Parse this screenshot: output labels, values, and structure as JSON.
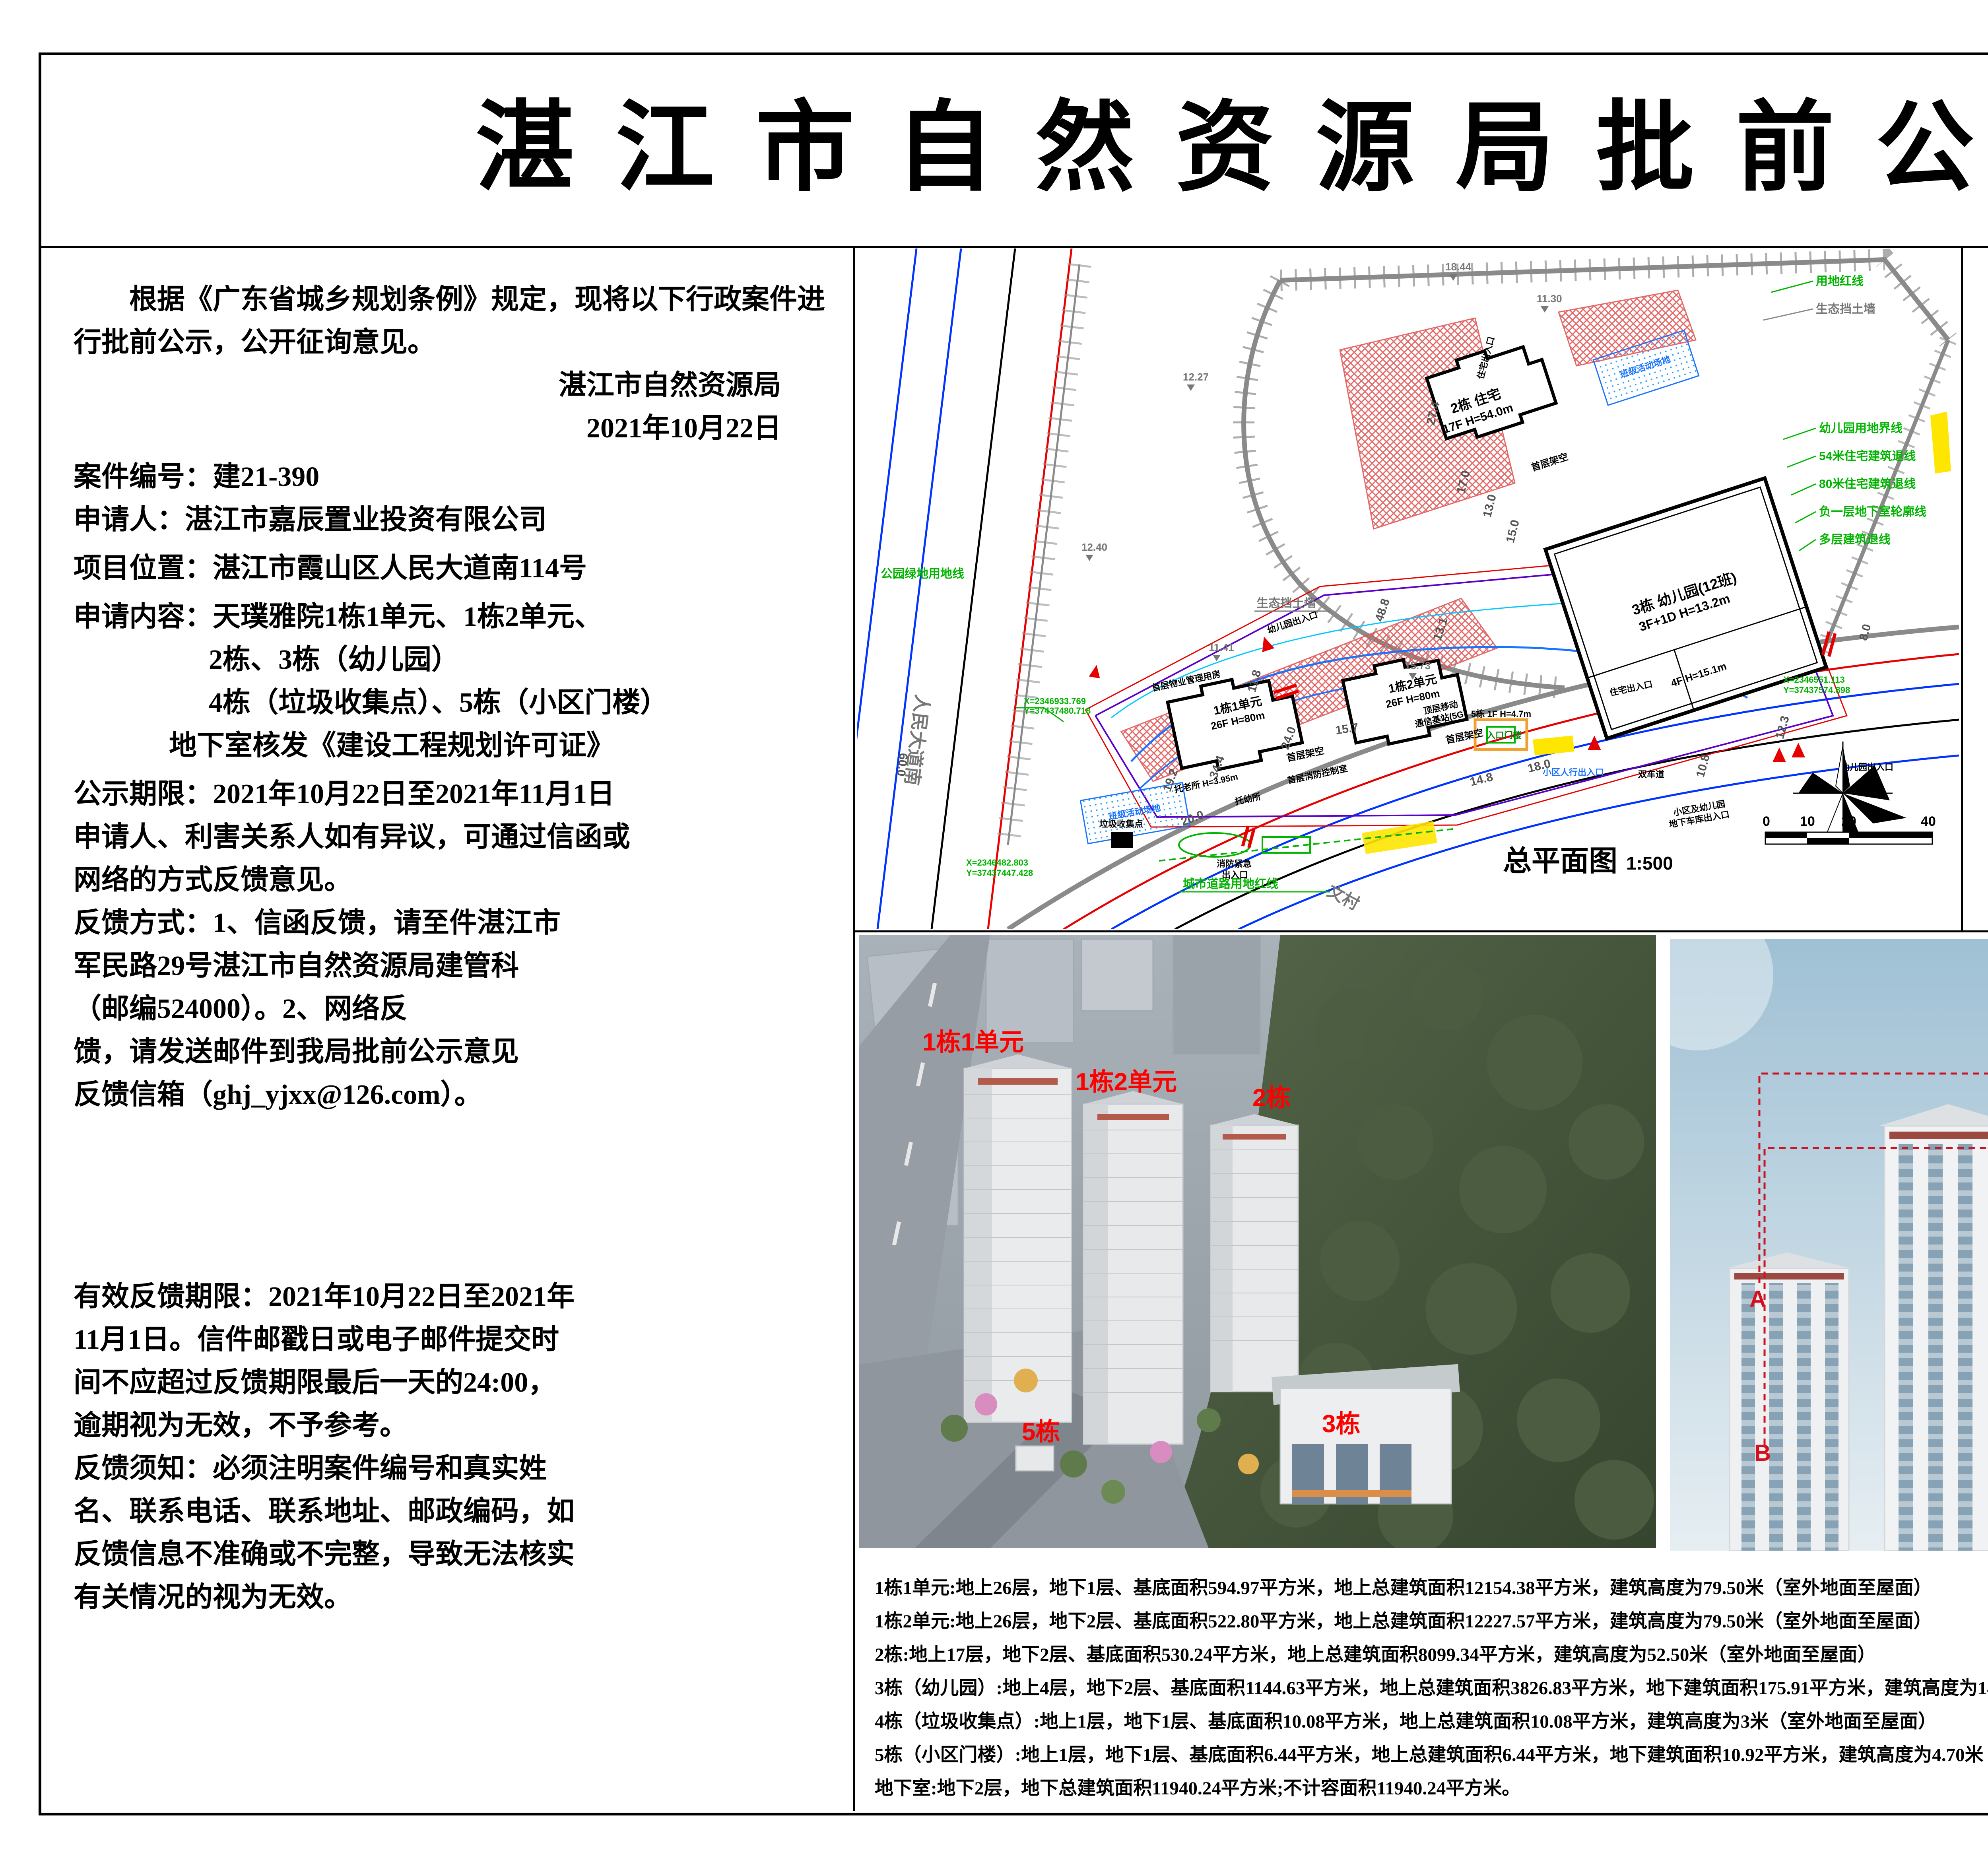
{
  "title": "湛江市自然资源局批前公示",
  "left": {
    "intro": "根据《广东省城乡规划条例》规定，现将以下行政案件进行批前公示，公开征询意见。",
    "agency": "湛江市自然资源局",
    "date": "2021年10月22日",
    "case_no": "案件编号：建21-390",
    "applicant": "申请人：湛江市嘉辰置业投资有限公司",
    "location": "项目位置：湛江市霞山区人民大道南114号",
    "content1": "申请内容：天璞雅院1栋1单元、1栋2单元、",
    "content2": "2栋、3栋（幼儿园）",
    "content3": "4栋（垃圾收集点）、5栋（小区门楼）",
    "content4": "地下室核发《建设工程规划许可证》",
    "period": "公示期限：2021年10月22日至2021年11月1日\n申请人、利害关系人如有异议，可通过信函或\n网络的方式反馈意见。",
    "method": "反馈方式：1、信函反馈，请至件湛江市\n军民路29号湛江市自然资源局建管科\n（邮编524000）。2、网络反\n馈，请发送邮件到我局批前公示意见\n反馈信箱（ghj_yjxx@126.com）。",
    "valid": "有效反馈期限：2021年10月22日至2021年\n11月1日。信件邮戳日或电子邮件提交时\n间不应超过反馈期限最后一天的24:00，\n逾期视为无效，不予参考。",
    "notice": "反馈须知：必须注明案件编号和真实姓\n名、联系电话、联系地址、邮政编码，如\n反馈信息不准确或不完整，导致无法核实\n有关情况的视为无效。"
  },
  "plan": {
    "name": "总平面图",
    "scale": "1:500",
    "ticks": [
      "0",
      "10",
      "20",
      "40"
    ],
    "labels": {
      "red_line": "用地红线",
      "eco_wall": "生态挡土墙",
      "kid_bound": "幼儿园用地界线",
      "setback54": "54米住宅建筑退线",
      "setback80": "80米住宅建筑退线",
      "basement": "负一层地下室轮廓线",
      "multi": "多层建筑退线",
      "b2a": "2栋 住宅",
      "b2b": "17F H=54.0m",
      "b3a": "3栋 幼儿园(12班)",
      "b3b": "3F+1D H=13.2m",
      "b3c": "4F H=15.1m",
      "b1u1a": "1栋1单元",
      "b1u1b": "26F H=80m",
      "b1u2a": "1栋2单元",
      "b1u2b": "26F H=80m",
      "stilt": "首层架空",
      "pm": "首层物业管理用房",
      "firectl": "首层消防控制室",
      "elder": "托老所 H=3.95m",
      "nursery": "托幼所",
      "sta1": "顶层移动",
      "sta2": "通信基站(5G)",
      "gate1": "5栋 1F H=4.7m",
      "gate2": "入口门楼",
      "ped": "小区人行出入口",
      "lane": "双车道",
      "garage1": "小区及幼儿园",
      "garage2": "地下车库出入口",
      "fire1": "消防紧急",
      "fire2": "出入口",
      "res_entry": "住宅出入口",
      "kid_entry": "幼儿园出入口",
      "play": "班级活动场地",
      "trash": "垃圾收集点",
      "road": "人民大道南",
      "wencun": "文村",
      "city_red": "城市道路用地红线",
      "park_green": "公园绿地用地线"
    },
    "dims": {
      "d1": "27.4",
      "d2": "17.0",
      "d3": "13.0",
      "d4": "15.0",
      "d5": "48.8",
      "d6": "13.1",
      "d7": "24.0",
      "d8": "34.4",
      "d9": "19.2",
      "d10": "11.8",
      "d11": "15.7",
      "d12": "20.0",
      "d13": "18.0",
      "d14": "14.8",
      "d15": "12.3",
      "d16": "10.8",
      "d17": "8.0",
      "d18": "60.0"
    },
    "elevs": {
      "m1": "12.27",
      "m2": "11.41",
      "m3": "12.40",
      "m4": "18.44",
      "m5": "11.30",
      "m6": "15.73"
    },
    "coords": {
      "c1a": "X=2346551.113",
      "c1b": "Y=37437574.898",
      "c2a": "X=2346482.803",
      "c2b": "Y=37437447.428",
      "c3a": "X=2346933.769",
      "c3b": "Y=37437480.718"
    }
  },
  "table": {
    "title": "表1、综合经济技术指标表",
    "h_item": "项目",
    "h_unit": "单位",
    "h_value": "建筑方案报批指标",
    "h_note": "备注",
    "qz": "其中",
    "rows": {
      "r01": {
        "l": "规划总用地面积",
        "u": "m²",
        "v": "11595.58",
        "n": ""
      },
      "r02": {
        "l": "规划住宅用地面积",
        "u": "m²",
        "v": "10779.42",
        "n": ""
      },
      "r03": {
        "l": "公园绿地用地面积",
        "u": "m²",
        "v": "306.84",
        "n": ""
      },
      "r04": {
        "l": "城市道路用地面积",
        "u": "m²",
        "v": "509.32",
        "n": ""
      },
      "r05": {
        "l": "总建筑面积",
        "u": "m²",
        "v": "48451.71",
        "n": ""
      },
      "r06": {
        "l": "计算容积率面积",
        "u": "m²",
        "v": "30180.50",
        "n": "全装修的住宅户数不小于50%"
      },
      "r07": {
        "l": "住宅建筑面积",
        "u": "m²",
        "v": "30021.59",
        "n": ""
      },
      "r08": {
        "l": "公建配套面积",
        "u": "m²",
        "v": "158.91",
        "n": ""
      },
      "r09": {
        "l": "人防报警间",
        "u": "m²",
        "v": "",
        "n": ""
      },
      "r10": {
        "l": "物业管理用房",
        "u": "m²",
        "v": "97.11",
        "n": ""
      },
      "r11": {
        "l": "消防控制室",
        "u": "m²",
        "v": "51.72",
        "n": ""
      },
      "r12": {
        "l": "垃圾收集点",
        "u": "m²",
        "v": "10.08",
        "n": ""
      },
      "r13": {
        "l": "小区门楼",
        "u": "m²",
        "v": "",
        "n": ""
      },
      "r14": {
        "l": "不计容建筑面积",
        "u": "m²",
        "v": "18271.21",
        "n": ""
      },
      "r15": {
        "l": "公建配套面积",
        "u": "m²",
        "v": "4203.56",
        "n": ""
      },
      "r16": {
        "l": "十二班幼儿园",
        "u": "m²",
        "v": "4002.74",
        "n": "含地下室面积175.91m²"
      },
      "r17": {
        "l": "托老所",
        "u": "m²",
        "v": "100.48",
        "n": ""
      },
      "r18": {
        "l": "托幼所",
        "u": "m²",
        "v": "100.34",
        "n": ""
      },
      "r19": {
        "l": "地下室建筑面积",
        "u": "m²",
        "v": "11951.16",
        "n": ""
      },
      "r20": {
        "l": "架空层",
        "u": "m²",
        "v": "443.87",
        "n": ""
      },
      "r21": {
        "l": "防火挑檐",
        "u": "m²",
        "v": "223.20",
        "n": ""
      },
      "r22": {
        "l": "结构板",
        "u": "m²",
        "v": "1449.42",
        "n": ""
      },
      "r23": {
        "l": "地上建筑面积",
        "u": "m²",
        "v": "36324.64",
        "n": ""
      },
      "r24": {
        "l": "地下建筑面积",
        "u": "m²",
        "v": "12127.07",
        "n": ""
      },
      "r25": {
        "l": "容积率",
        "u": "/",
        "v": "2.80",
        "n": ""
      },
      "r26": {
        "l": "建筑高度",
        "u": "m",
        "v": "80.00",
        "n": ""
      },
      "r27": {
        "l": "建筑基底面积",
        "u": "m²",
        "v": "2809.16",
        "n": ""
      },
      "r28": {
        "l": "建筑密度",
        "u": "/",
        "v": "26.06%",
        "n": ""
      },
      "r29": {
        "l": "绿地面积",
        "u": "m²",
        "v": "/",
        "n": ""
      },
      "r30": {
        "l": "宅旁绿地面积",
        "u": "m²",
        "v": "/",
        "n": ""
      },
      "r31": {
        "l": "组团式附属绿地",
        "u": "m²",
        "v": "/",
        "n": ""
      },
      "r32": {
        "l": "绿地率",
        "u": "/",
        "v": "/",
        "n": ""
      },
      "r33": {
        "l": "户数",
        "u": "",
        "v": "269",
        "n": ""
      },
      "r34": {
        "l": "地下机动车位",
        "u": "个",
        "v": "321",
        "n": "100%预留安装充电设施接口，"
      },
      "r35": {
        "l": "非机动车位",
        "u": "个",
        "v": "164",
        "n": ""
      }
    },
    "footnote": "备注：1、机动车位尺寸5.30*2.40米，非机动车按1.6m²/个折算。\n2、防火挑檐计算建筑面积未纳入容积率计算。"
  },
  "aerial": {
    "b1u1": "1栋1单元",
    "b1u2": "1栋2单元",
    "b2": "2栋",
    "b3": "3栋",
    "b5": "5栋"
  },
  "elev": {
    "legend_title": "采用国家建筑外墙色卡标准 CBCC 色卡编号",
    "a_mark": "A",
    "a_name": "1、白色质感涂料",
    "a_code": "编号：1331  5.6GY/1",
    "a_color": "#f3f4f6",
    "b_mark": "B",
    "b_name": "2、深灰色质感涂料",
    "b_code": "编号：1712  N4.75",
    "b_color": "#75797d",
    "c_mark": "C",
    "c_name": "3、红色质感涂料",
    "c_code": "编号：1074  3.8R3/5.6",
    "c_color": "#8e1b21"
  },
  "bottom": {
    "l1": "1栋1单元:地上26层，地下1层、基底面积594.97平方米，地上总建筑面积12154.38平方米，建筑高度为79.50米（室外地面至屋面）",
    "l2": "1栋2单元:地上26层，地下2层、基底面积522.80平方米，地上总建筑面积12227.57平方米，建筑高度为79.50米（室外地面至屋面）",
    "l3": "2栋:地上17层，地下2层、基底面积530.24平方米，地上总建筑面积8099.34平方米，建筑高度为52.50米（室外地面至屋面）",
    "l4": "3栋（幼儿园）:地上4层，地下2层、基底面积1144.63平方米，地上总建筑面积3826.83平方米，地下建筑面积175.91平方米，建筑高度为14.60米（室外地面至屋面）",
    "l5": "4栋（垃圾收集点）:地上1层，地下1层、基底面积10.08平方米，地上总建筑面积10.08平方米，建筑高度为3米（室外地面至屋面）",
    "l6": "5栋（小区门楼）:地上1层，地下1层、基底面积6.44平方米，地上总建筑面积6.44平方米，地下建筑面积10.92平方米，建筑高度为4.70米（室外地面至屋面）",
    "l7": "地下室:地下2层，地下总建筑面积11940.24平方米;不计容面积11940.24平方米。"
  }
}
